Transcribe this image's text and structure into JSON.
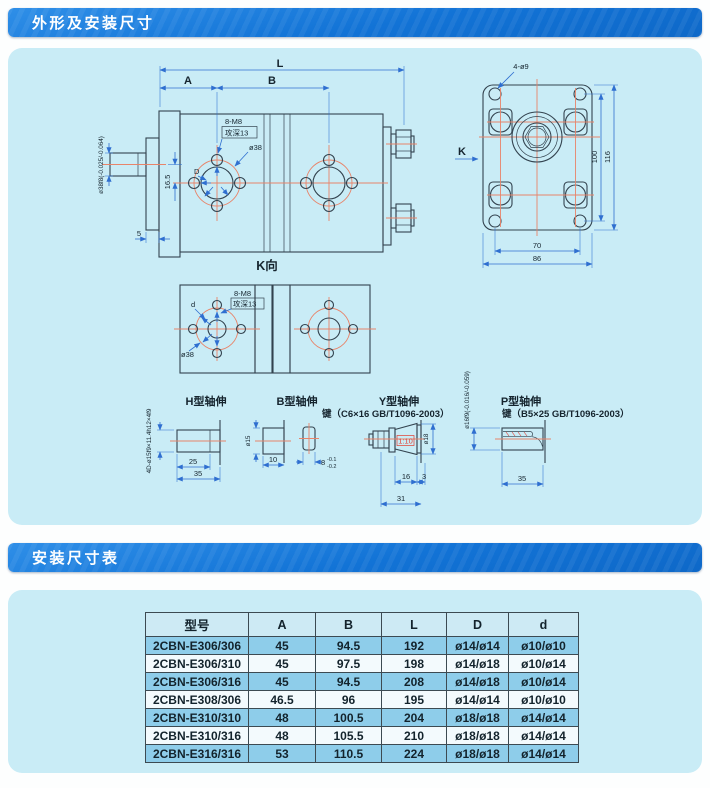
{
  "sections": {
    "dimensions_title": "外形及安装尺寸",
    "table_title": "安装尺寸表"
  },
  "drawing": {
    "main_view": {
      "dim_l": "L",
      "dim_a": "A",
      "dim_b": "B",
      "thread_label": "8-M8",
      "thread_depth": "攻深13",
      "bolt_circle": "ø38",
      "port_label": "D",
      "offset_dim": "16.5",
      "flange_dim": "5",
      "shaft_dia": "ø38f8(-0.025/-0.064)"
    },
    "end_view": {
      "holes_label": "4-ø9",
      "k_label": "K",
      "dim_height_inner": "100",
      "dim_height_outer": "116",
      "dim_width_inner": "70",
      "dim_width_outer": "86"
    },
    "k_view": {
      "caption": "K向",
      "thread_label": "8-M8",
      "thread_depth": "攻深13",
      "d_label": "d",
      "bolt_circle": "ø38"
    },
    "shaft_h": {
      "title": "H型轴伸",
      "spline_spec": "4D-ø15f9×11.4h12×4f9",
      "dim_25": "25",
      "dim_35": "35"
    },
    "shaft_b": {
      "title": "B型轴伸",
      "dia": "ø15",
      "dim_10": "10",
      "key_width": "8",
      "key_tol_upper": "-0.1",
      "key_tol_lower": "-0.2"
    },
    "shaft_y": {
      "title": "Y型轴伸",
      "key_spec": "键（C6×16  GB/T1096-2003）",
      "taper": "1:10",
      "dia": "ø18",
      "dim_16": "16",
      "dim_3": "3",
      "dim_31": "31"
    },
    "shaft_p": {
      "title": "P型轴伸",
      "key_spec": "键（B5×25  GB/T1096-2003）",
      "dia": "ø16f9(-0.016/-0.059)",
      "dim_35": "35"
    }
  },
  "table": {
    "headers": [
      "型号",
      "A",
      "B",
      "L",
      "D",
      "d"
    ],
    "rows": [
      [
        "2CBN-E306/306",
        "45",
        "94.5",
        "192",
        "ø14/ø14",
        "ø10/ø10"
      ],
      [
        "2CBN-E306/310",
        "45",
        "97.5",
        "198",
        "ø14/ø18",
        "ø10/ø14"
      ],
      [
        "2CBN-E306/316",
        "45",
        "94.5",
        "208",
        "ø14/ø18",
        "ø10/ø14"
      ],
      [
        "2CBN-E308/306",
        "46.5",
        "96",
        "195",
        "ø14/ø14",
        "ø10/ø10"
      ],
      [
        "2CBN-E310/310",
        "48",
        "100.5",
        "204",
        "ø18/ø18",
        "ø14/ø14"
      ],
      [
        "2CBN-E310/316",
        "48",
        "105.5",
        "210",
        "ø18/ø18",
        "ø14/ø14"
      ],
      [
        "2CBN-E316/316",
        "53",
        "110.5",
        "224",
        "ø18/ø18",
        "ø14/ø14"
      ]
    ],
    "highlight_rows": [
      0,
      2,
      4,
      6
    ]
  },
  "colors": {
    "bar_blue": "#1273d6",
    "panel_cyan": "#c9ecf6",
    "row_blue": "#8ecdea",
    "row_white": "#f3fafd",
    "centerline_red": "#e8846a",
    "dimension_blue": "#2f6fd0",
    "object_line": "#33434f",
    "taper_red": "#e23c2e"
  }
}
